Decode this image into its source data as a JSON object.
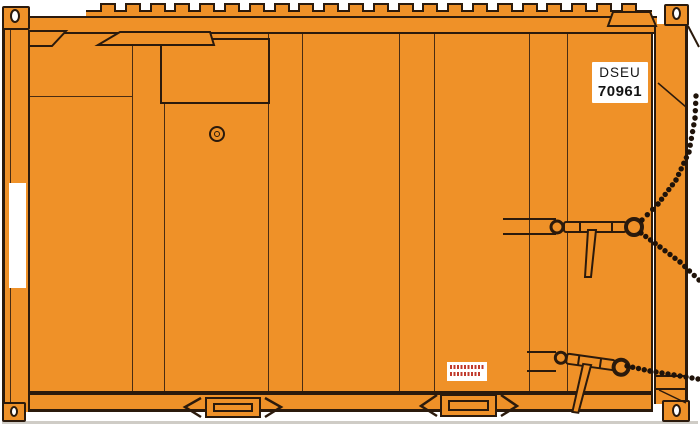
{
  "id_placard": {
    "line1": "DSEU",
    "line2": "70961"
  },
  "warning_placard": {
    "line_count": 2,
    "text_illegible": true
  },
  "roof": {
    "rib_count": 22
  },
  "colors": {
    "body_orange": "#EF9128",
    "outline": "#2B1A0C",
    "seam": "#4A2C12",
    "white": "#FFFFFF",
    "warning_red": "#C0392B",
    "chain": "#1F130A",
    "ground_shadow": "#CFCCC6",
    "placard_text": "#141414"
  }
}
